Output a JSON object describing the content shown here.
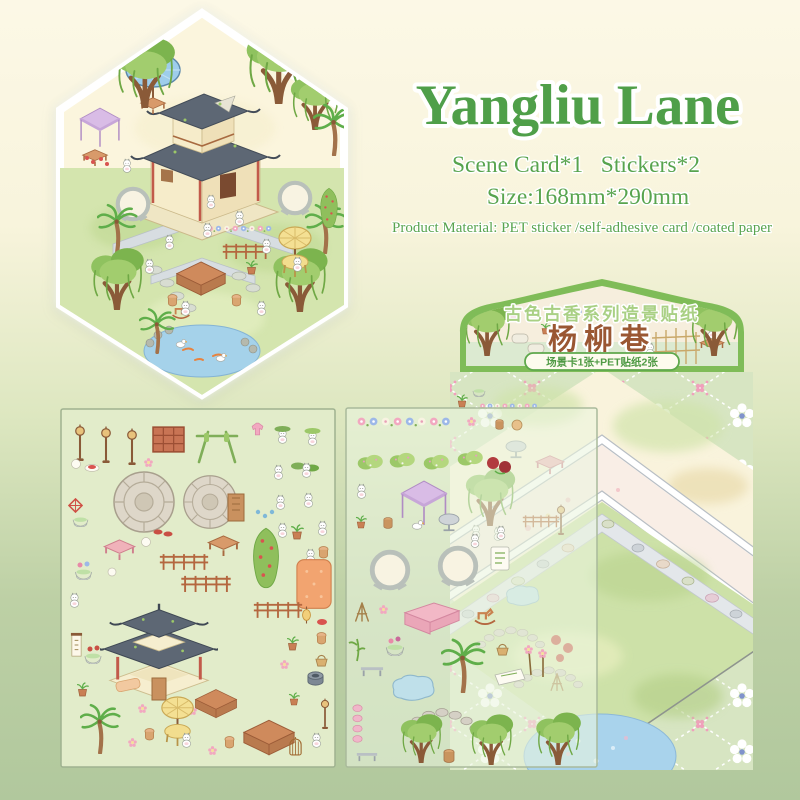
{
  "page": {
    "background_top": "#fcf8e6",
    "background_bottom": "#b1c89d"
  },
  "title_block": {
    "title": "Yangliu Lane",
    "title_color": "#4f9f49",
    "contents_line": "Scene Card*1   Stickers*2",
    "size_line": "Size:168mm*290mm",
    "material_line": "Product Material: PET sticker /self-adhesive card /coated paper",
    "text_color": "#58a44e"
  },
  "package": {
    "series_label": "古色古香系列造景贴纸",
    "product_name": "杨柳巷",
    "contents_badge": "场景卡1张+PET贴纸2张",
    "series_text_color": "#a9d084",
    "name_text_color": "#9a5733",
    "badge_text_color": "#4f9a44",
    "border_color": "#7fbc58",
    "card_pattern_background": "#d7e5c2",
    "courtyard_ground": "#f9f3dc",
    "courtyard_grass": "#cde1a8",
    "pond_color": "#a9d3ec"
  },
  "hex_scene": {
    "items": [
      "two-story teahouse",
      "willow trees",
      "palm trees",
      "blue parasol",
      "purple market canopy",
      "moon gates",
      "stone paths",
      "koi pond",
      "white cat figures",
      "tea tables",
      "yellow parasol table",
      "flower hedges"
    ]
  },
  "sheet1": {
    "items": [
      "street lamps",
      "red window frame",
      "bamboo rack",
      "stone platforms",
      "pink table",
      "wood tables",
      "fences",
      "berry hedge",
      "orange mat",
      "pavilion",
      "palm tree",
      "yellow parasol table",
      "square tables",
      "birdcage",
      "white cats",
      "potted plants",
      "hanging scroll",
      "kite"
    ]
  },
  "sheet2": {
    "items": [
      "flower garland",
      "bushes",
      "purple canopy",
      "moon gates",
      "pink cabinet",
      "rocking horse",
      "round table",
      "tripod rack",
      "pond stone",
      "stone arc path",
      "willow trees",
      "palm tree",
      "benches",
      "white cats",
      "flower bowls"
    ]
  }
}
